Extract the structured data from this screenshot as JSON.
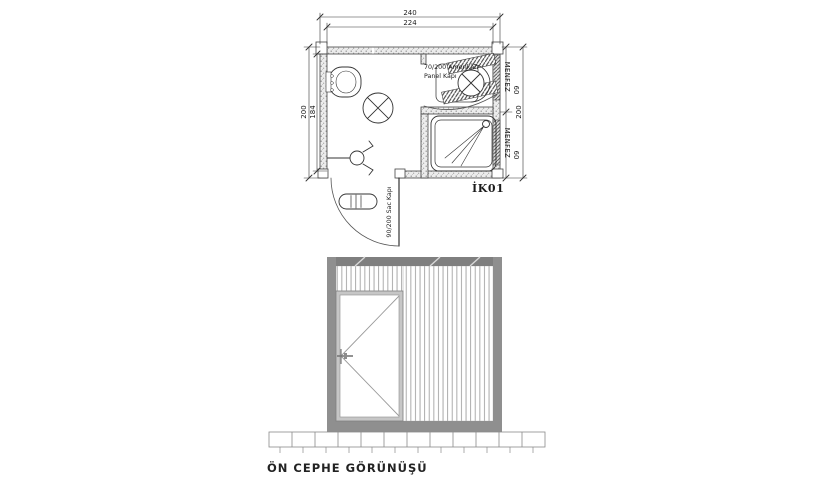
{
  "plan": {
    "dimensions": {
      "top_outer": "240",
      "top_inner": "224",
      "left_outer": "200",
      "left_inner": "184",
      "right_outer": "200",
      "vent_top_size": "60",
      "vent_bottom_size": "60"
    },
    "labels": {
      "panel_door_line1": "70/200 Amerikan",
      "panel_door_line2": "Panel Kapı",
      "entry_door": "90/200 Sac Kapı",
      "vent_top": "MENFEZ",
      "vent_bottom": "MENFEZ",
      "unit_code": "İK01"
    }
  },
  "elevation": {
    "caption": "ÖN CEPHE GÖRÜNÜŞÜ"
  },
  "colors": {
    "line": "#3a3a3a",
    "wall_fill": "#ececec",
    "frame_gray": "#8f8f8f",
    "top_beam_gray": "#7f7f7f",
    "door_frame_gray": "#c6c6c6",
    "background": "#ffffff"
  }
}
